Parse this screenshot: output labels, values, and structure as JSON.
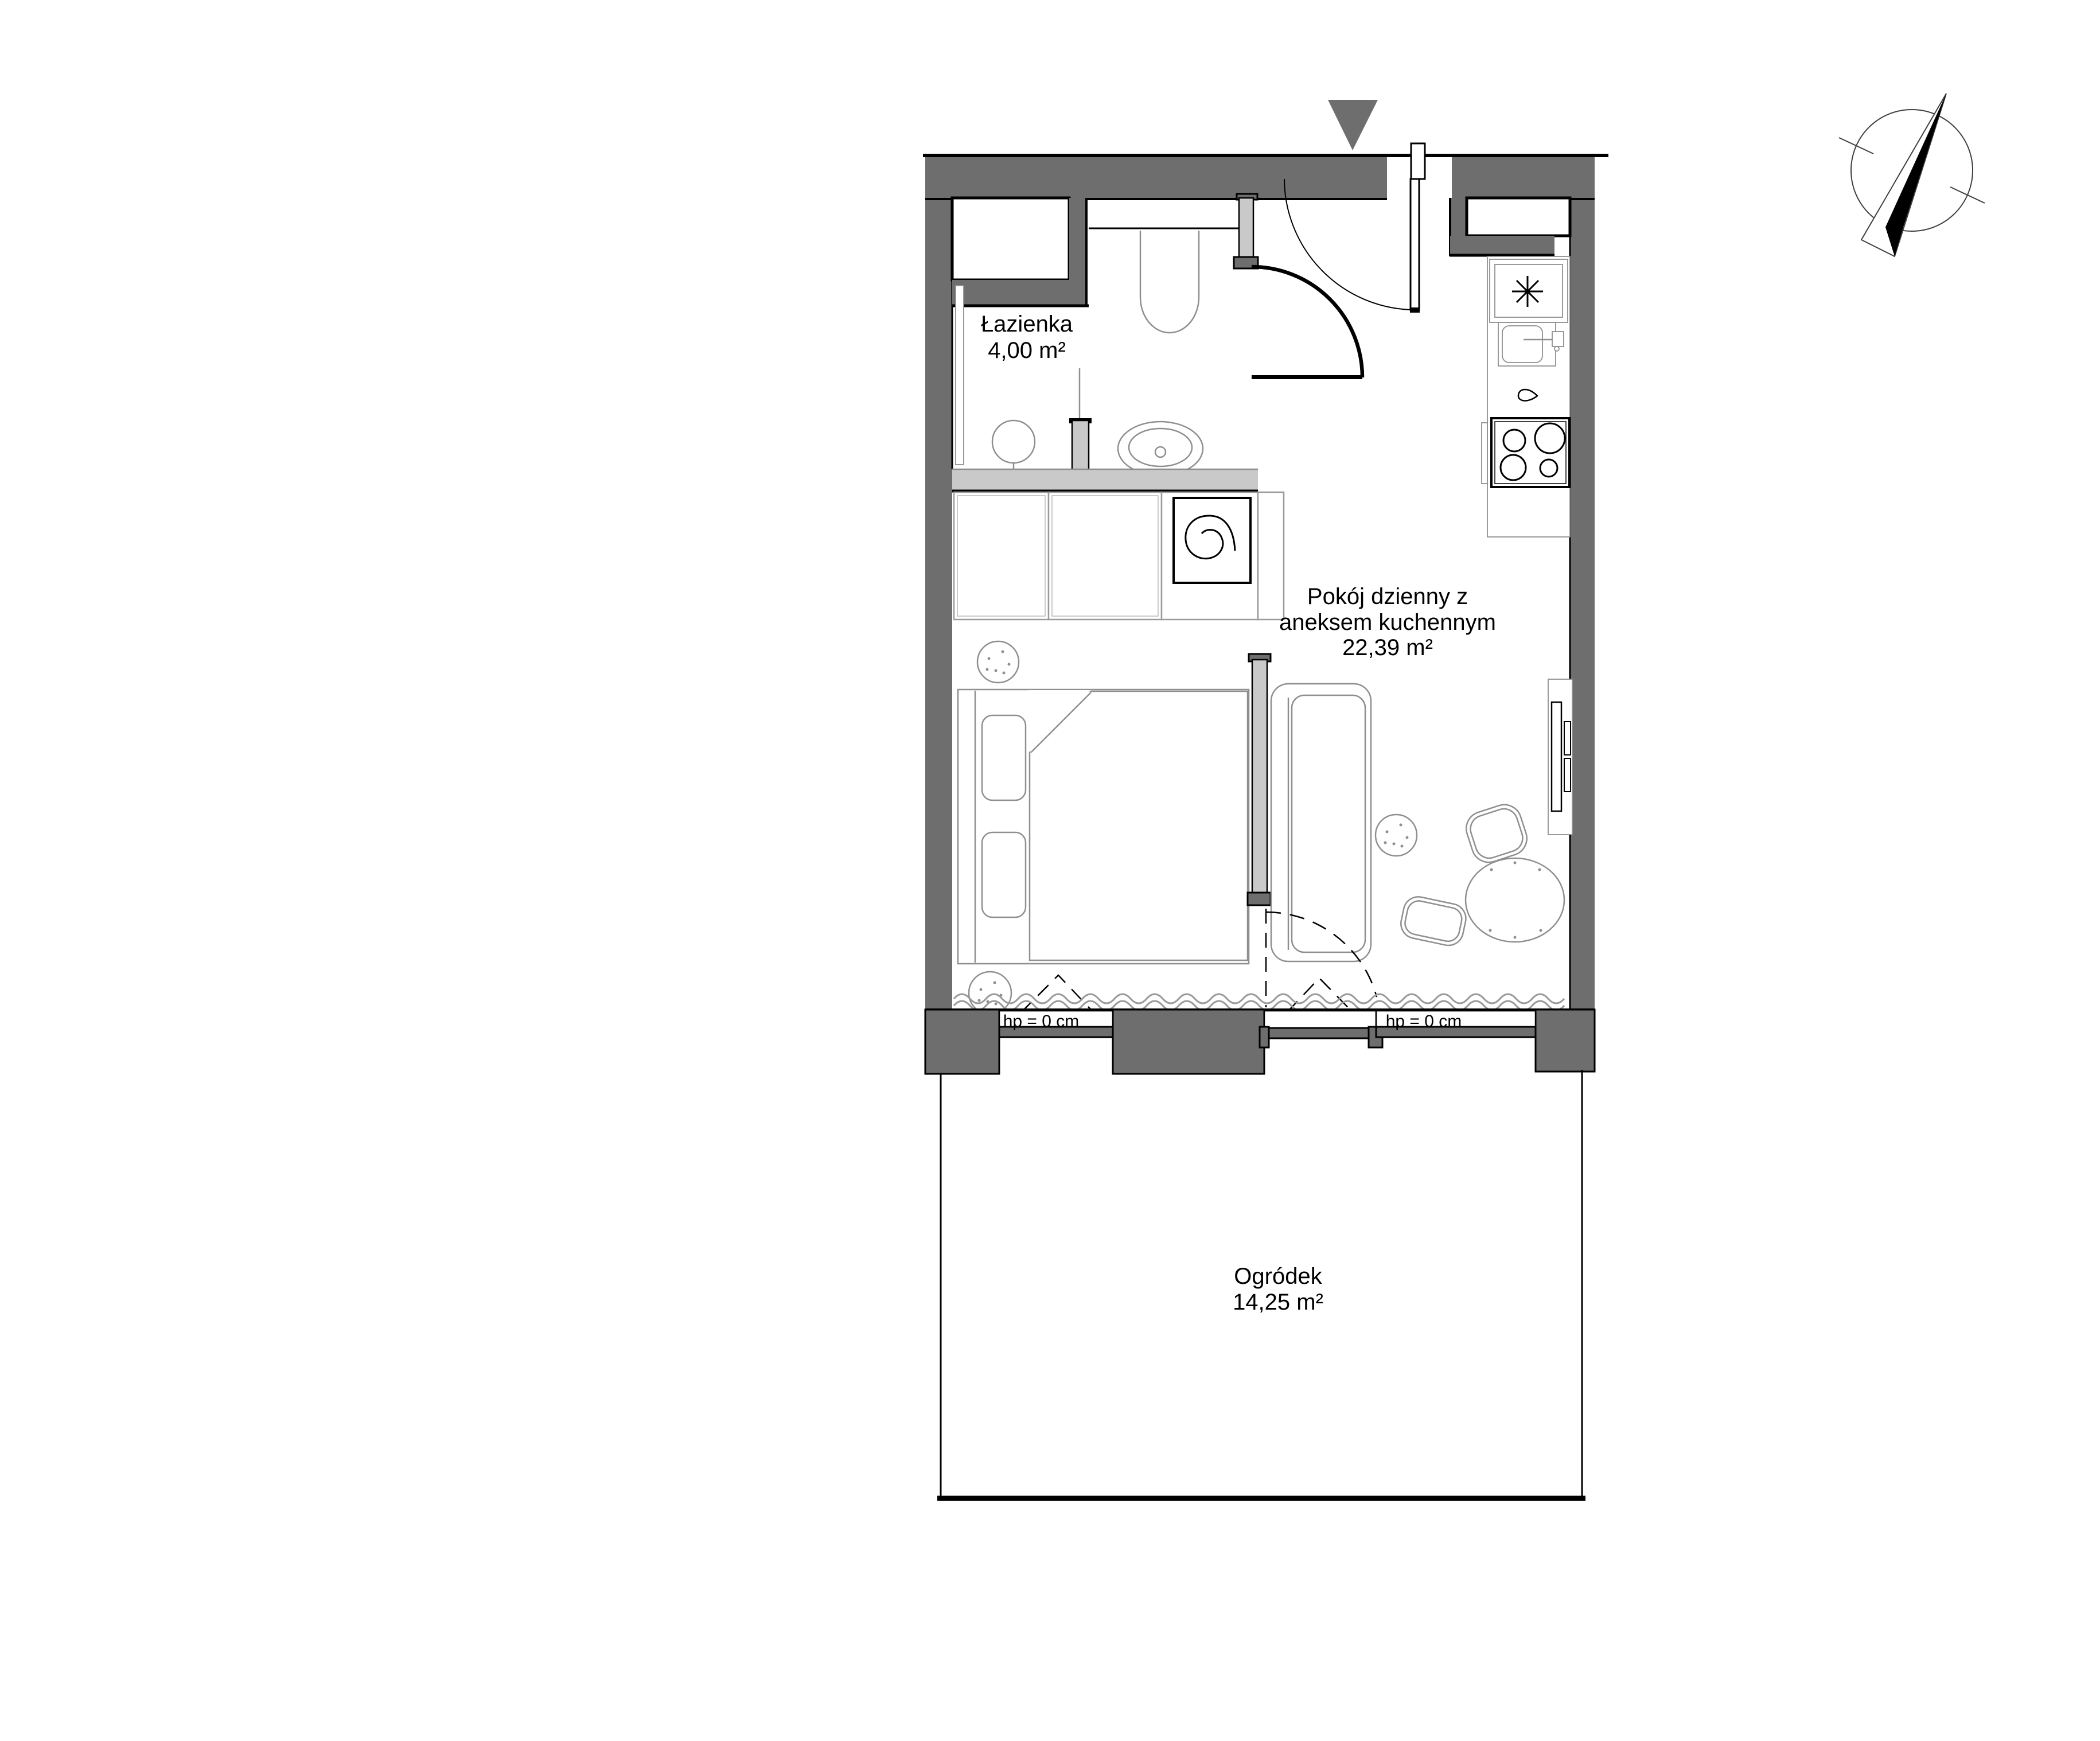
{
  "page": {
    "background": "#ffffff",
    "type": "architectural-floor-plan"
  },
  "plan": {
    "rooms": [
      {
        "name": "Łazienka",
        "area": "4,00 m²"
      },
      {
        "name": "Pokój dzienny z",
        "name_line2": "aneksem kuchennym",
        "area": "22,39 m²"
      },
      {
        "name": "Ogródek",
        "area": "14,25 m²"
      }
    ],
    "window_sill_labels": [
      "hp = 0 cm",
      "hp = 0 cm"
    ],
    "colors": {
      "wall": "#6e6e6e",
      "wall_light": "#c9c9c9",
      "line": "#000000",
      "furniture_outline": "#8f8f8f",
      "curtain": "#9a9a9a",
      "compass": "#3f3f3f"
    },
    "icons": [
      "north-compass-icon",
      "entrance-arrow-icon",
      "fridge-frost-asterisk-icon",
      "washing-machine-spiral-icon",
      "shower-head-icon",
      "cooktop-burners-icon",
      "kitchen-sink-icon",
      "toilet-icon",
      "washbasin-icon",
      "drain-teardrop-icon"
    ]
  }
}
